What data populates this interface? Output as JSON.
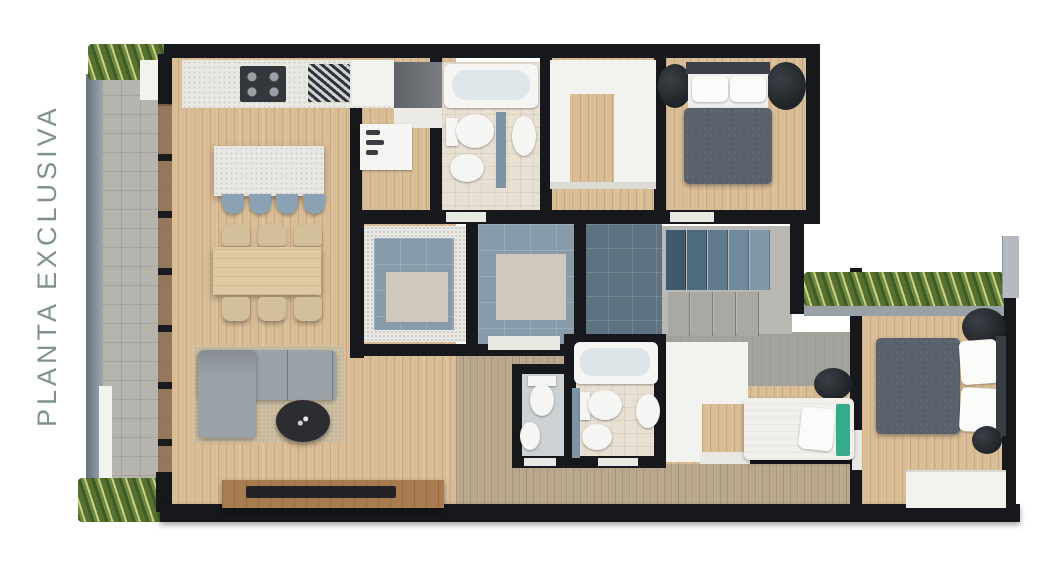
{
  "label": {
    "text": "PLANTA EXCLUSIVA",
    "color": "#7f938b"
  },
  "palette": {
    "wall": "#17181c",
    "wood": "#d8bd96",
    "wood_dark": "#b9a88e",
    "tile_terrace": "#b6b4af",
    "tile_blue": "#879baa",
    "plant_green": "#55702f",
    "sofa_gray": "#9aa1a7",
    "duvet_gray": "#59616d",
    "headboard_green": "#35ab8c",
    "rug_beige": "#cdbfa3",
    "tv_wood": "#a87c4f",
    "label_color": "#7f938b",
    "background": "#ffffff"
  },
  "rooms": [
    {
      "name": "terrace",
      "label": "terrace with planters"
    },
    {
      "name": "kitchen",
      "label": "kitchen with island and stools"
    },
    {
      "name": "dining-room",
      "label": "dining table with six chairs"
    },
    {
      "name": "living-room",
      "label": "L-shaped sofa, rug, coffee table, tv console"
    },
    {
      "name": "laundry",
      "label": "laundry room"
    },
    {
      "name": "bathroom-1",
      "label": "bathtub, toilet, bidet, washbasin"
    },
    {
      "name": "walk-in-closet",
      "label": "U-shaped wardrobe"
    },
    {
      "name": "bedroom-1",
      "label": "double bed, nightstand plants"
    },
    {
      "name": "elevator",
      "label": "elevator / light well"
    },
    {
      "name": "hall",
      "label": "entry hall"
    },
    {
      "name": "stairs",
      "label": "staircase"
    },
    {
      "name": "bathroom-2",
      "label": "toilet and washbasin"
    },
    {
      "name": "bathroom-3",
      "label": "bathtub, toilet, bidet, washbasin"
    },
    {
      "name": "bedroom-3",
      "label": "single bed with green headboard"
    },
    {
      "name": "bedroom-2",
      "label": "double bed, wardrobe, stool"
    }
  ]
}
